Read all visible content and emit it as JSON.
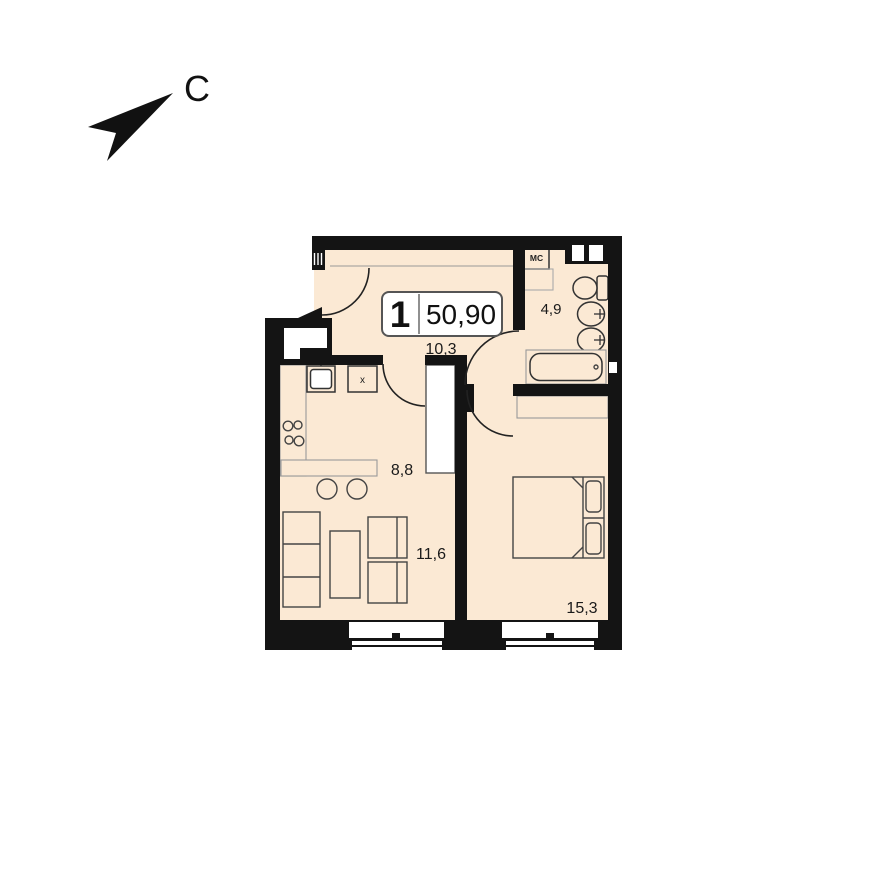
{
  "compass": {
    "north_label": "С"
  },
  "info_box": {
    "apartment_number": "1",
    "total_area": "50,90"
  },
  "rooms": {
    "hallway": {
      "area": "10,3"
    },
    "bathroom": {
      "area": "4,9"
    },
    "kitchen": {
      "area": "8,8"
    },
    "living_room": {
      "area": "11,6"
    },
    "bedroom": {
      "area": "15,3"
    }
  },
  "fixtures": {
    "washing_machine_label": "МС",
    "kitchen_cabinet_label": "х"
  },
  "colors": {
    "floor_fill": "#FBE9D4",
    "wall": "#141414",
    "background": "#FFFFFF",
    "furniture_outline": "#444444"
  }
}
